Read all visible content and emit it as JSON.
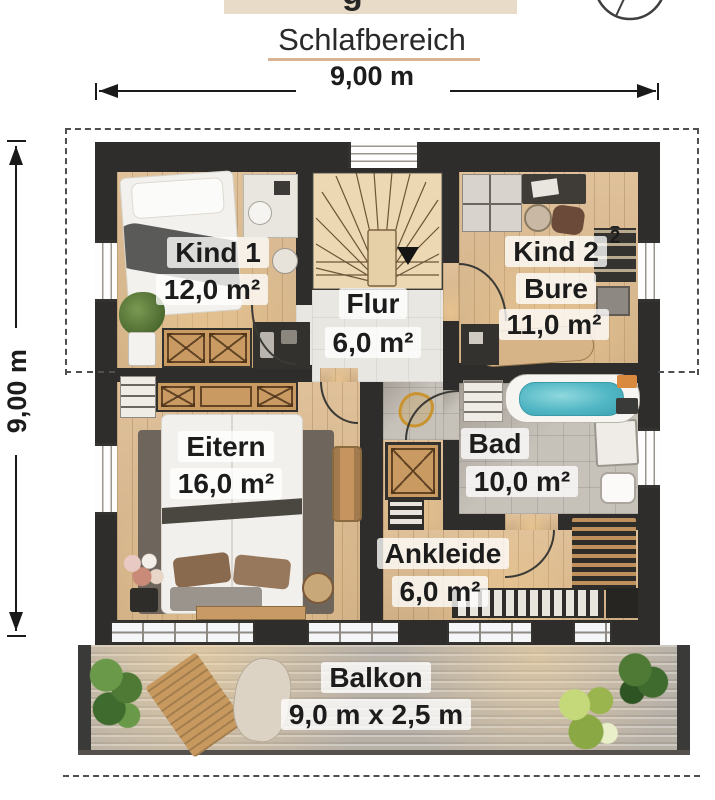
{
  "header": {
    "partial_title_descender": "g",
    "title": "Schlafbereich"
  },
  "dimensions": {
    "width_label": "9,00 m",
    "height_label": "9,00 m"
  },
  "rooms": {
    "kind1": {
      "name": "Kind 1",
      "area": "12,0 m²"
    },
    "kind2": {
      "name": "Kind 2",
      "artifact": "2",
      "name2": "Bure",
      "area": "11,0 m²"
    },
    "flur": {
      "name": "Flur",
      "area": "6,0 m²"
    },
    "eltern": {
      "name": "Eitern",
      "area": "16,0 m²"
    },
    "bad": {
      "name": "Bad",
      "area": "10,0 m²"
    },
    "ankleide": {
      "name": "Ankleide",
      "area": "6,0 m²"
    },
    "balkon": {
      "name": "Balkon",
      "size": "9,0 m x 2,5 m"
    }
  },
  "colors": {
    "wall": "#2e2d2b",
    "wood_floor": "#dcba8e",
    "hall_tile": "#e9e7e2",
    "bath_tile": "#c6c1b9",
    "bathtub_water": "#52b7c4",
    "header_box": "#e8dbc8",
    "title_underline": "#d8b492"
  }
}
